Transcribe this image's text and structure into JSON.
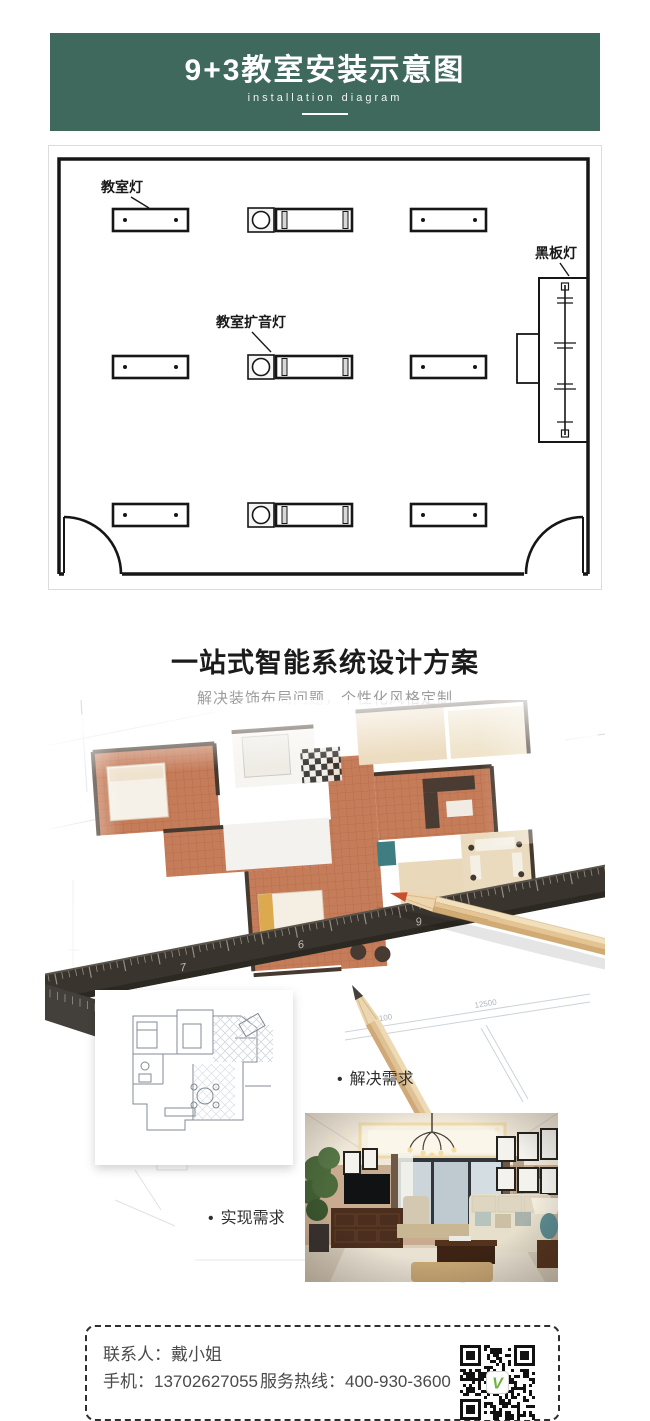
{
  "header": {
    "title": "9+3教室安装示意图",
    "subtitle": "installation diagram",
    "bg_color": "#3f695d"
  },
  "classroom_diagram": {
    "label_classroom_light": "教室灯",
    "label_amplifier_light": "教室扩音灯",
    "label_blackboard_light": "黑板灯"
  },
  "design_section": {
    "title": "一站式智能系统设计方案",
    "subtitle": "解决装饰布局问题，个性化风格定制",
    "bullet_char": "•",
    "bullet_solve": "解决需求",
    "bullet_realize": "实现需求",
    "ruler_marks": [
      "7",
      "6",
      "9"
    ],
    "dim_labels": [
      "5100",
      "12500"
    ]
  },
  "contact": {
    "person": "联系人：戴小姐",
    "mobile": "手机：13702627055",
    "hotline": "服务热线：400-930-3600",
    "qr_logo_letter": "V"
  },
  "colors": {
    "accent_green": "#3f695d",
    "terracotta": "#c57c59",
    "cream": "#ecdcc0",
    "ruler_dark": "#39342e",
    "qr_green": "#6cb33f"
  }
}
